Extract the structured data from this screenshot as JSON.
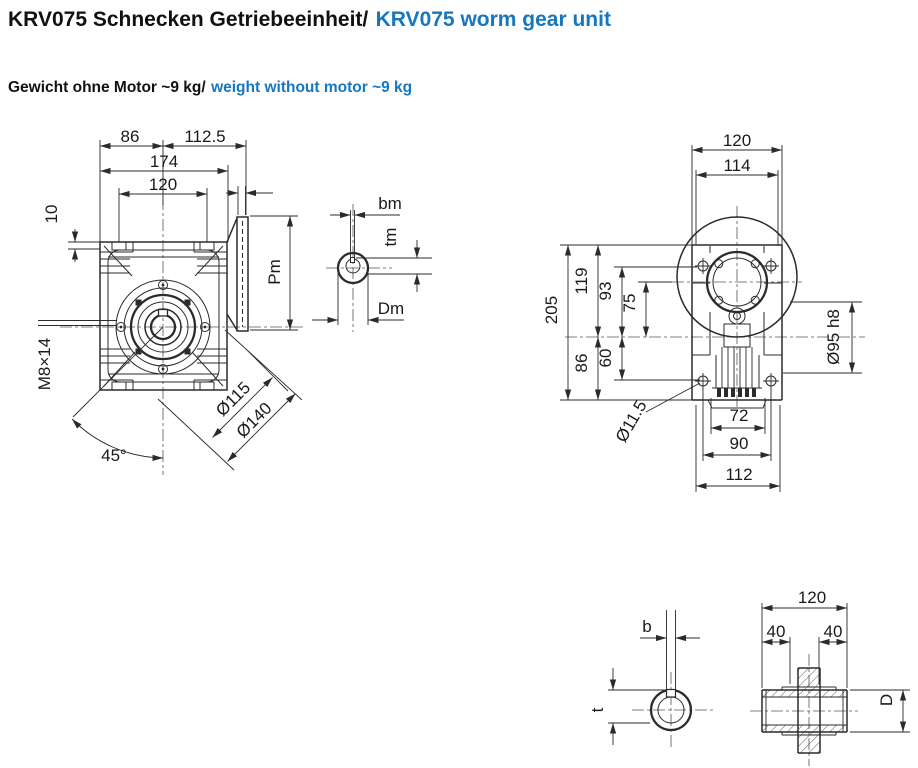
{
  "header": {
    "title_de": "KRV075 Schnecken Getriebeeinheit/",
    "title_en": "KRV075 worm gear unit",
    "subtitle_de": "Gewicht ohne Motor ~9 kg/",
    "subtitle_en": "weight without motor ~9 kg",
    "accent_color": "#1577bd"
  },
  "front_view": {
    "dims": {
      "left_to_axis": "86",
      "axis_to_flange_face": "112.5",
      "overall_width": "174",
      "mount_slot_spacing": "120",
      "foot_offset": "10",
      "tapped_hole": "M8×14",
      "flange_angle": "45°",
      "bolt_circle_dia": "Ø115",
      "flange_dia": "Ø140",
      "motor_flange_height": "Pm"
    }
  },
  "motor_shaft_section": {
    "key_width": "bm",
    "key_depth": "tm",
    "shaft_dia": "Dm"
  },
  "side_view": {
    "dims": {
      "overall_depth": "120",
      "face_depth": "114",
      "overall_height": "205",
      "top_to_axis": "119",
      "bolt_top_to_axis": "93",
      "input_axis_offset": "75",
      "axis_to_bottom": "86",
      "axis_to_bolt_bottom": "60",
      "spigot_dia": "Ø95 h8",
      "mount_hole_dia": "Ø11.5",
      "fin_width": "72",
      "bolt_spacing": "90",
      "base_width": "112"
    }
  },
  "output_bore_section": {
    "key_width": "b",
    "key_depth": "t"
  },
  "hollow_shaft_section": {
    "overall_length": "120",
    "hub_left": "40",
    "hub_right": "40",
    "shaft_dia": "D"
  }
}
